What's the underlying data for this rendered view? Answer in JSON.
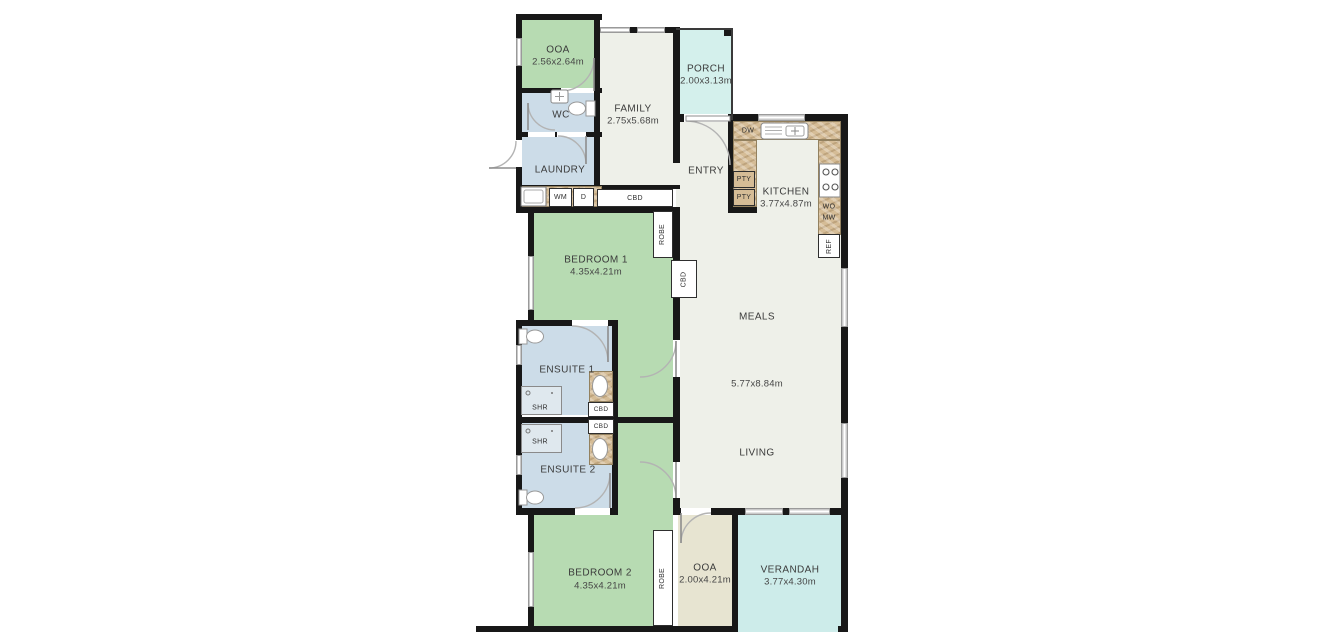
{
  "rooms": {
    "ooa_top": {
      "name": "OOA",
      "dims": "2.56x2.64m"
    },
    "wc": {
      "name": "WC"
    },
    "laundry": {
      "name": "LAUNDRY"
    },
    "family": {
      "name": "FAMILY",
      "dims": "2.75x5.68m"
    },
    "porch": {
      "name": "PORCH",
      "dims": "2.00x3.13m"
    },
    "entry": {
      "name": "ENTRY"
    },
    "kitchen": {
      "name": "KITCHEN",
      "dims": "3.77x4.87m"
    },
    "meals": {
      "name": "MEALS"
    },
    "living": {
      "name": "LIVING"
    },
    "open_area": {
      "dims": "5.77x8.84m"
    },
    "bedroom1": {
      "name": "BEDROOM 1",
      "dims": "4.35x4.21m"
    },
    "ensuite1": {
      "name": "ENSUITE 1"
    },
    "ensuite2": {
      "name": "ENSUITE 2"
    },
    "bedroom2": {
      "name": "BEDROOM 2",
      "dims": "4.35x4.21m"
    },
    "ooa_bottom": {
      "name": "OOA",
      "dims": "2.00x4.21m"
    },
    "verandah": {
      "name": "VERANDAH",
      "dims": "3.77x4.30m"
    }
  },
  "fixtures": {
    "robe_bed1": "ROBE",
    "robe_bed2": "ROBE",
    "cbd_hall": "CBD",
    "cbd_closet": "CBD",
    "cbd_ensuite1": "CBD",
    "cbd_ensuite2": "CBD",
    "shr_ensuite1": "SHR",
    "shr_ensuite2": "SHR",
    "washing_machine": "WM",
    "dryer": "D",
    "dishwasher": "DW",
    "pantry_top": "PTY",
    "pantry_bottom": "PTY",
    "wall_oven": "WO",
    "microwave": "MW",
    "fridge": "REF"
  },
  "colors": {
    "wall": "#181818",
    "bedroom_green": "#b7dbb2",
    "wet_area_blue": "#ccdce8",
    "floor_cream": "#eef0e9",
    "porch_cyan": "#d4f0ec",
    "verandah_cyan": "#cdecea",
    "ooa_beige": "#e7e4d1",
    "counter_tan": "#d5bc96"
  }
}
